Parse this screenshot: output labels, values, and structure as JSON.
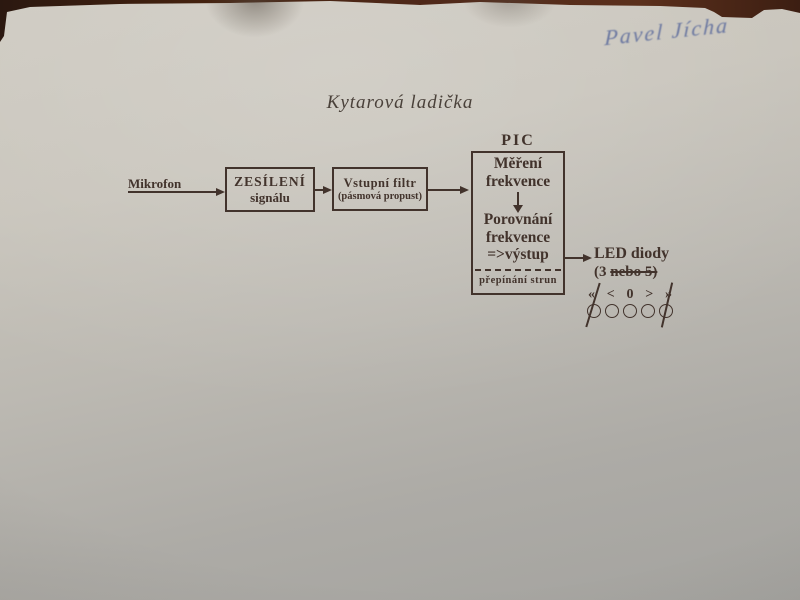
{
  "photo": {
    "handwritten_name": "Pavel Jícha"
  },
  "title": "Kytarová ladička",
  "diagram": {
    "mikrofon_label": "Mikrofon",
    "amp_box": {
      "line1": "ZESÍLENÍ",
      "line2": "signálu"
    },
    "filter_box": {
      "line1": "Vstupní filtr",
      "line2": "(pásmová propust)"
    },
    "pic": {
      "label": "PIC",
      "block1_line1": "Měření",
      "block1_line2": "frekvence",
      "block2_line1": "Porovnání",
      "block2_line2": "frekvence",
      "block2_line3": "=>výstup",
      "footer": "přepínání strun"
    },
    "led": {
      "line1": "LED diody",
      "line2_normal": "(3 ",
      "line2_struck": "nebo 5)",
      "symbols": [
        "«",
        "<",
        "0",
        ">",
        "»"
      ],
      "symbols_struck_indices": [
        0,
        4
      ],
      "led_count": 5,
      "circles_struck_indices": [
        0,
        4
      ]
    }
  },
  "colors": {
    "ink": "#42332c",
    "handwriting_ink": "#5c6b9c",
    "paper_light": "#ccc8bf",
    "paper_dark": "#a5a4a0",
    "table_background": "#4a2517"
  }
}
